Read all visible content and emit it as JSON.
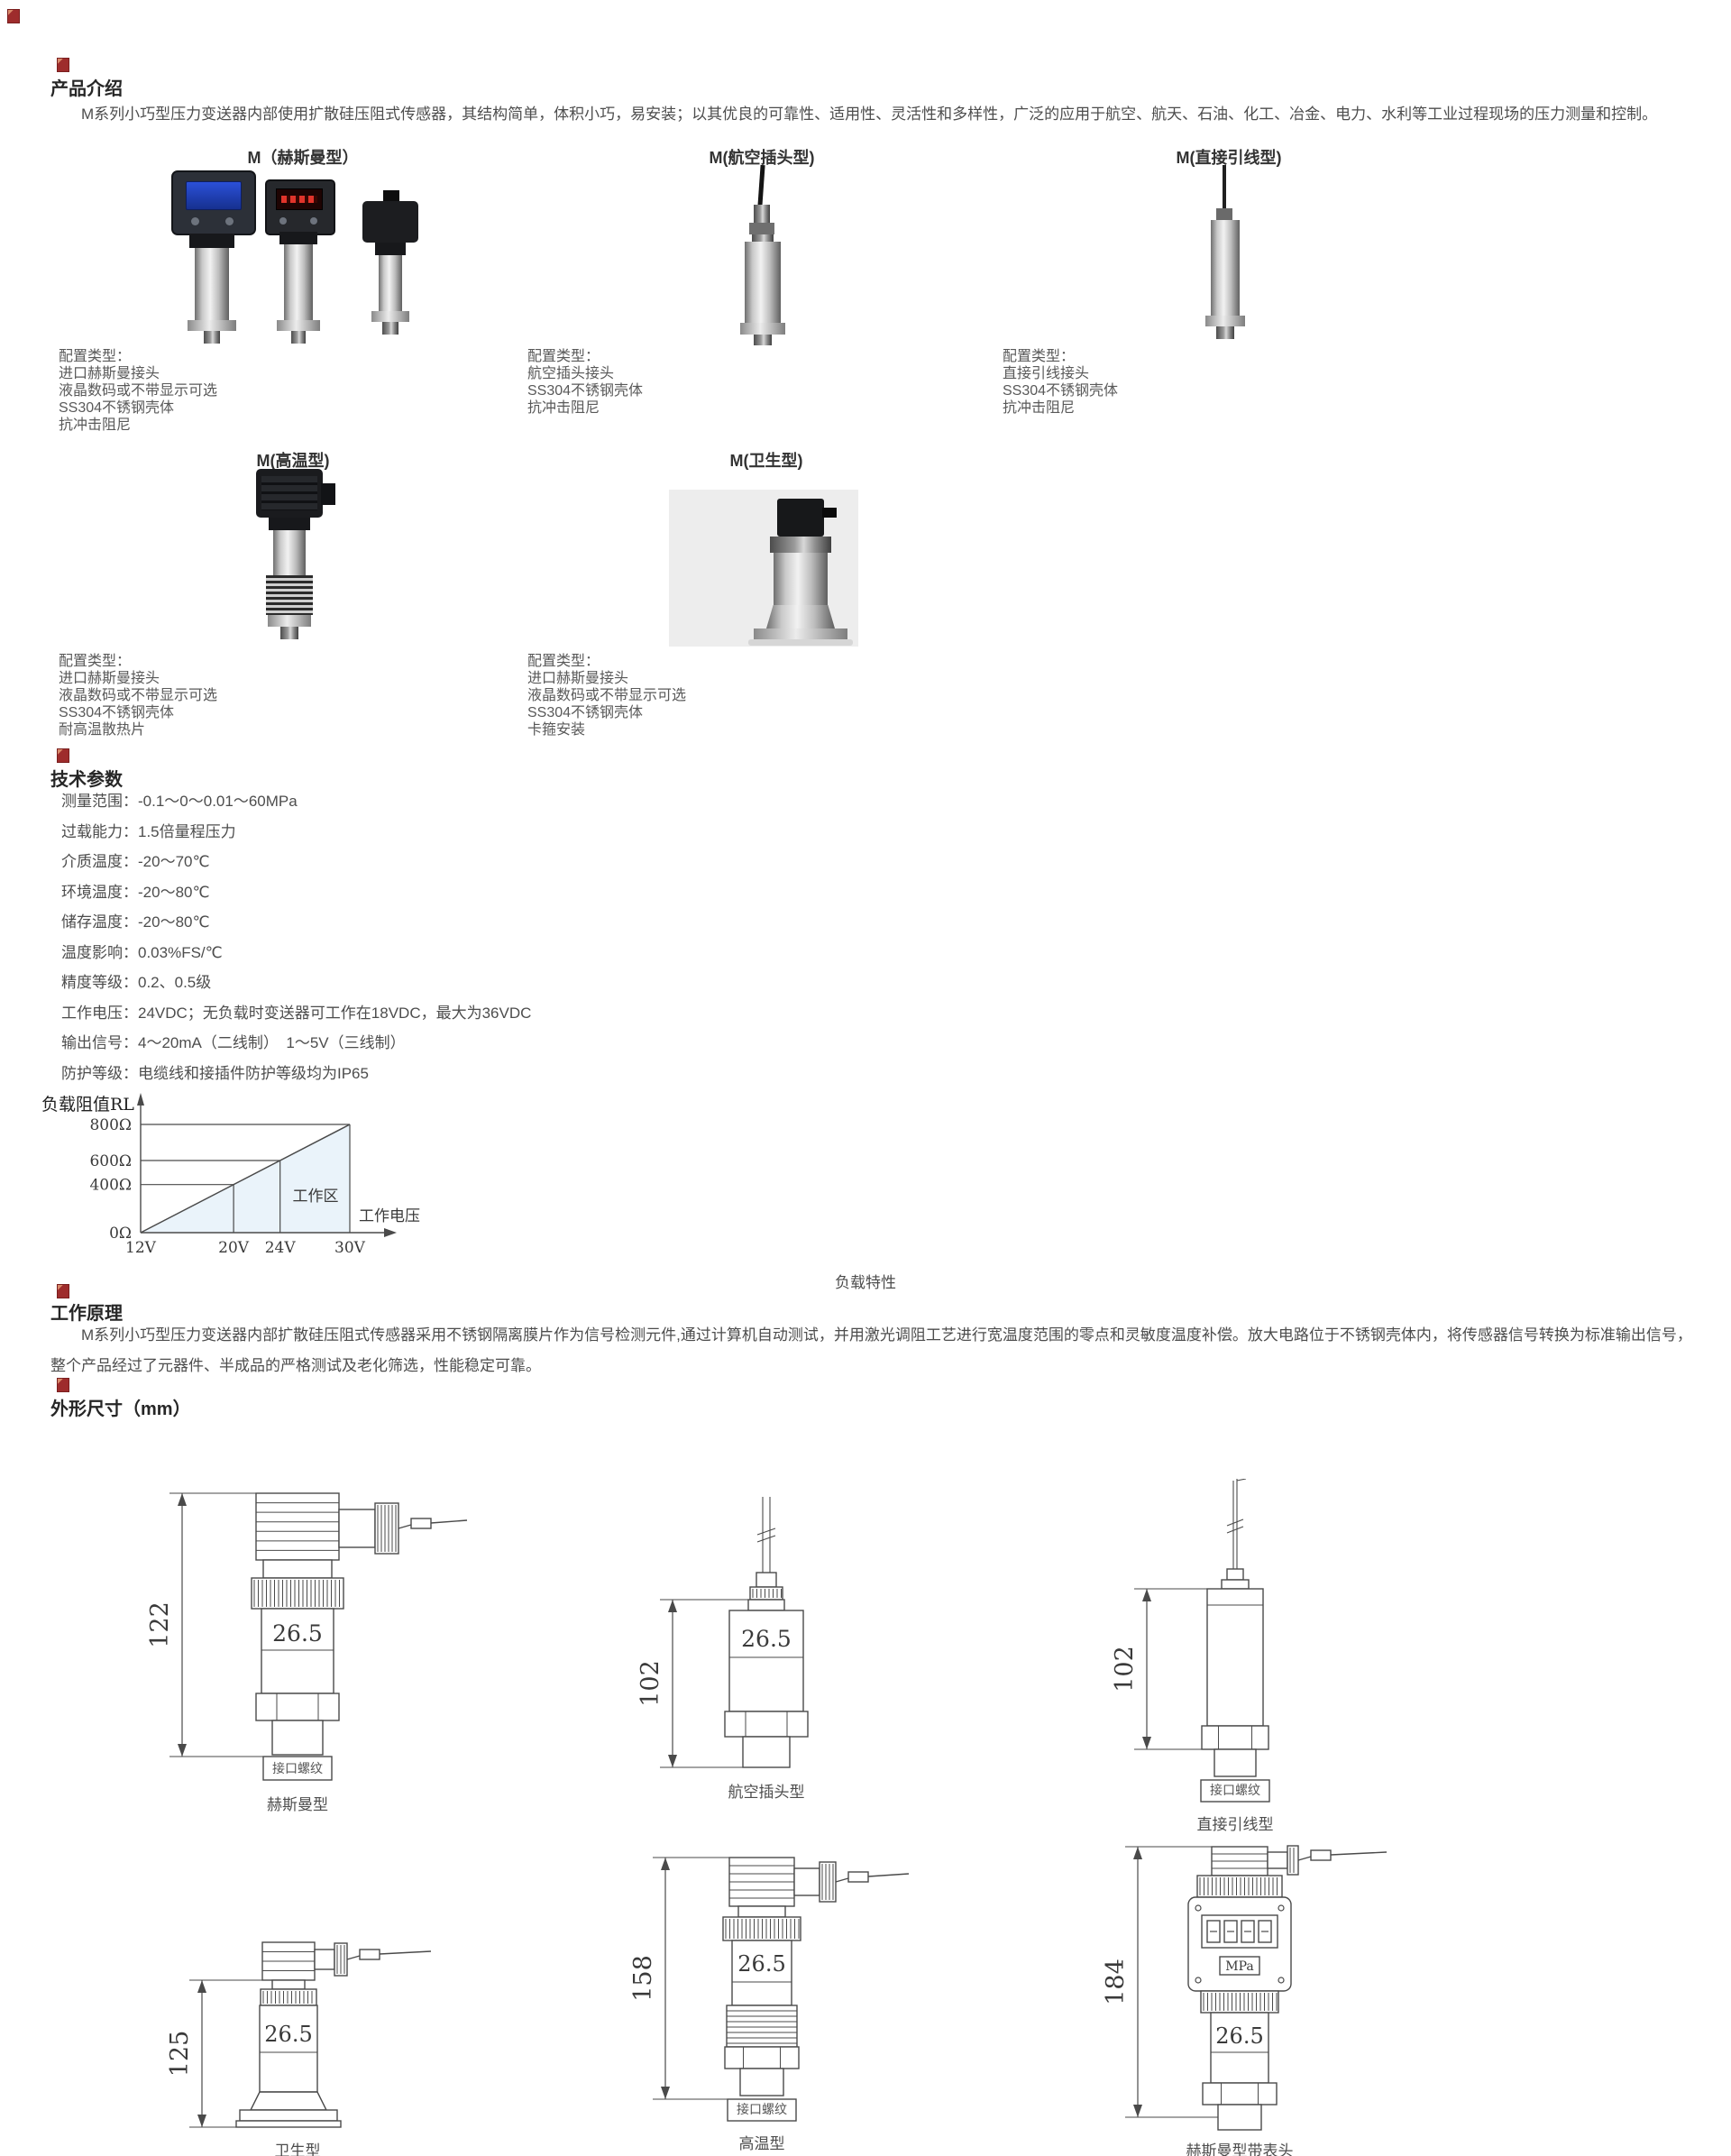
{
  "page": {
    "background": "#ffffff",
    "accent": "#9e2c2c"
  },
  "icons": {
    "section_marker": "broken-image-icon"
  },
  "intro": {
    "heading": "产品介绍",
    "body": "M系列小巧型压力变送器内部使用扩散硅压阻式传感器，其结构简单，体积小巧，易安装；以其优良的可靠性、适用性、灵活性和多样性，广泛的应用于航空、航天、石油、化工、冶金、电力、水利等工业过程现场的压力测量和控制。"
  },
  "models_row1": [
    {
      "label": "M（赫斯曼型）",
      "config": [
        "配置类型：",
        "进口赫斯曼接头",
        "液晶数码或不带显示可选",
        "SS304不锈钢壳体",
        "抗冲击阻尼"
      ]
    },
    {
      "label": "M(航空插头型)",
      "config": [
        "配置类型：",
        "航空插头接头",
        "SS304不锈钢壳体",
        "抗冲击阻尼"
      ]
    },
    {
      "label": "M(直接引线型)",
      "config": [
        "配置类型：",
        "直接引线接头",
        "SS304不锈钢壳体",
        "抗冲击阻尼"
      ]
    }
  ],
  "models_row2": [
    {
      "label": "M(高温型)",
      "config": [
        "配置类型：",
        "进口赫斯曼接头",
        "液晶数码或不带显示可选",
        "SS304不锈钢壳体",
        "耐高温散热片"
      ]
    },
    {
      "label": "M(卫生型)",
      "config": [
        "配置类型：",
        "进口赫斯曼接头",
        "液晶数码或不带显示可选",
        "SS304不锈钢壳体",
        "卡箍安装"
      ]
    }
  ],
  "tech": {
    "heading": "技术参数",
    "params": [
      "测量范围：-0.1～0～0.01～60MPa",
      "过载能力：1.5倍量程压力",
      "介质温度：-20～70℃",
      "环境温度：-20～80℃",
      "储存温度：-20～80℃",
      "温度影响：0.03%FS/℃",
      "精度等级：0.2、0.5级",
      "工作电压：24VDC；无负载时变送器可工作在18VDC，最大为36VDC",
      "输出信号：4～20mA（二线制）　1～5V（三线制）",
      "防护等级：电缆线和接插件防护等级均为IP65"
    ]
  },
  "principle": {
    "heading": "工作原理",
    "body": "M系列小巧型压力变送器内部扩散硅压阻式传感器采用不锈钢隔离膜片作为信号检测元件,通过计算机自动测试，并用激光调阻工艺进行宽温度范围的零点和灵敏度温度补偿。放大电路位于不锈钢壳体内，将传感器信号转换为标准输出信号，整个产品经过了元器件、半成品的严格测试及老化筛选，性能稳定可靠。"
  },
  "dimensions": {
    "heading": "外形尺寸（mm）",
    "drawings": [
      {
        "id": "hirschmann",
        "caption": "赫斯曼型",
        "dim": "122",
        "body_label": "26.5",
        "thread_label": "接口螺纹",
        "display_unit": ""
      },
      {
        "id": "aviation",
        "caption": "航空插头型",
        "dim": "102",
        "body_label": "26.5",
        "thread_label": "",
        "display_unit": ""
      },
      {
        "id": "wire",
        "caption": "直接引线型",
        "dim": "102",
        "body_label": "",
        "thread_label": "接口螺纹",
        "display_unit": ""
      },
      {
        "id": "sanitary",
        "caption": "卫生型",
        "dim": "125",
        "body_label": "26.5",
        "thread_label": "",
        "display_unit": ""
      },
      {
        "id": "hightemp",
        "caption": "高温型",
        "dim": "158",
        "body_label": "26.5",
        "thread_label": "接口螺纹",
        "display_unit": ""
      },
      {
        "id": "display",
        "caption": "赫斯曼型带表头",
        "dim": "184",
        "body_label": "26.5",
        "thread_label": "",
        "display_unit": "MPa"
      }
    ]
  },
  "chart_data": {
    "type": "area",
    "title": "负载特性",
    "xlabel": "工作电压",
    "ylabel": "负载阻值RL",
    "x": [
      12,
      20,
      24,
      30
    ],
    "x_tick_labels": [
      "12V",
      "20V",
      "24V",
      "30V"
    ],
    "y": [
      0,
      400,
      600,
      800
    ],
    "y_tick_labels": [
      "0Ω",
      "400Ω",
      "600Ω",
      "800Ω"
    ],
    "series": [
      {
        "name": "负载阻值RL",
        "points": [
          [
            12,
            0
          ],
          [
            30,
            800
          ]
        ]
      }
    ],
    "region_label": "工作区",
    "xlim": [
      12,
      32
    ],
    "ylim": [
      0,
      900
    ],
    "grid": false,
    "legend": "none",
    "fill_color": "#eaf3fa",
    "line_color": "#4a4a4a"
  }
}
